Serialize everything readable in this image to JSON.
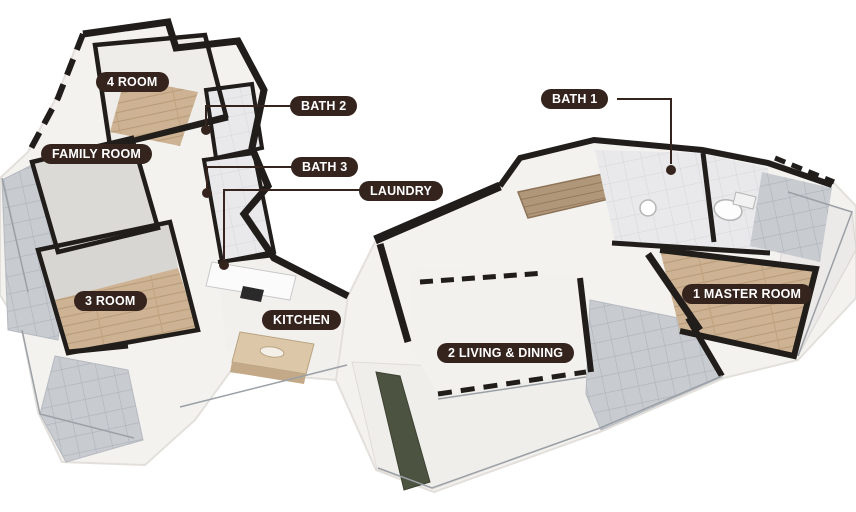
{
  "colors": {
    "label_bg": "#35231e",
    "label_text": "#ffffff",
    "wall": "#201d1b",
    "wood_floor": "#cdb394",
    "wood_dark": "#b1977a",
    "gray_tile": "#c8ccd1",
    "light_tile": "#e9e9eb",
    "island": "#dcc8a8",
    "planter": "#4c5340",
    "plate": "#f4f2ef",
    "background": "#ffffff"
  },
  "floorplan": {
    "type": "3d-isometric-apartment-floor-plan",
    "labels": [
      {
        "id": "room4",
        "text": "4 ROOM"
      },
      {
        "id": "family-room",
        "text": "FAMILY ROOM"
      },
      {
        "id": "bath2",
        "text": "BATH 2"
      },
      {
        "id": "bath3",
        "text": "BATH 3"
      },
      {
        "id": "laundry",
        "text": "LAUNDRY"
      },
      {
        "id": "bath1",
        "text": "BATH 1"
      },
      {
        "id": "room3",
        "text": "3 ROOM"
      },
      {
        "id": "kitchen",
        "text": "KITCHEN"
      },
      {
        "id": "living-dining",
        "text": "2 LIVING & DINING"
      },
      {
        "id": "master-room",
        "text": "1 MASTER ROOM"
      }
    ]
  }
}
